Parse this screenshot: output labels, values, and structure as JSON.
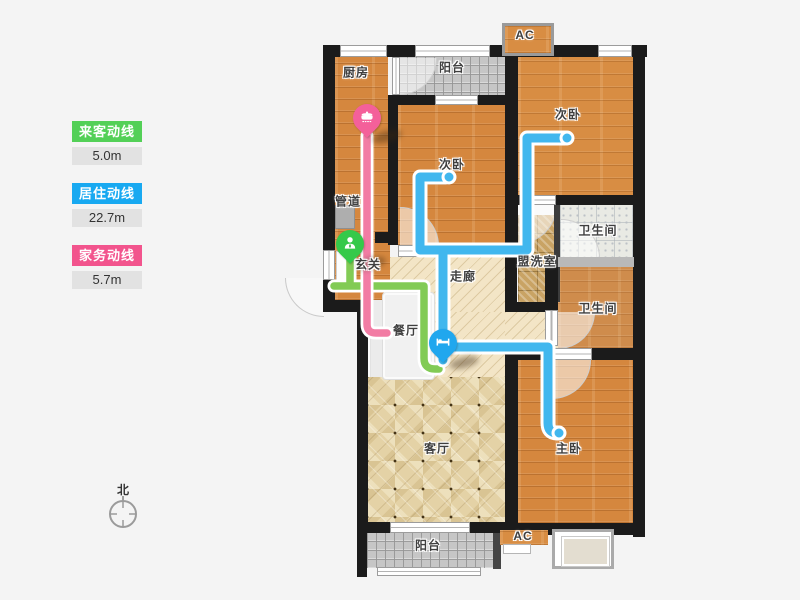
{
  "legend": {
    "items": [
      {
        "id": "visitor",
        "label": "来客动线",
        "value": "5.0m",
        "color": "#53d057"
      },
      {
        "id": "resident",
        "label": "居住动线",
        "value": "22.7m",
        "color": "#18a9f1"
      },
      {
        "id": "housework",
        "label": "家务动线",
        "value": "5.7m",
        "color": "#f2548d"
      }
    ]
  },
  "compass": {
    "label": "北"
  },
  "rooms": {
    "kitchen": {
      "label": "厨房"
    },
    "balcony_top": {
      "label": "阳台"
    },
    "ac_top": {
      "label": "AC"
    },
    "bedroom_center": {
      "label": "次卧"
    },
    "bedroom_topright": {
      "label": "次卧"
    },
    "pipe_duct": {
      "label": "管道"
    },
    "entry": {
      "label": "玄关"
    },
    "corridor": {
      "label": "走廊"
    },
    "washroom": {
      "label": "盟洗室"
    },
    "bathroom_top": {
      "label": "卫生间"
    },
    "bathroom_bottom": {
      "label": "卫生间"
    },
    "dining": {
      "label": "餐厅"
    },
    "living": {
      "label": "客厅"
    },
    "master": {
      "label": "主卧"
    },
    "balcony_bottom": {
      "label": "阳台"
    },
    "ac_bottom": {
      "label": "AC"
    }
  },
  "markers": {
    "housework_start": {
      "icon": "pot-icon",
      "color": "#f4609a"
    },
    "visitor_start": {
      "icon": "person-icon",
      "color": "#35c94a"
    },
    "resident_start": {
      "icon": "bed-icon",
      "color": "#20a7ee"
    }
  },
  "lines": {
    "visitor_color": "#82cb55",
    "resident_color": "#41b7ee",
    "housework_color": "#f27ca4"
  }
}
